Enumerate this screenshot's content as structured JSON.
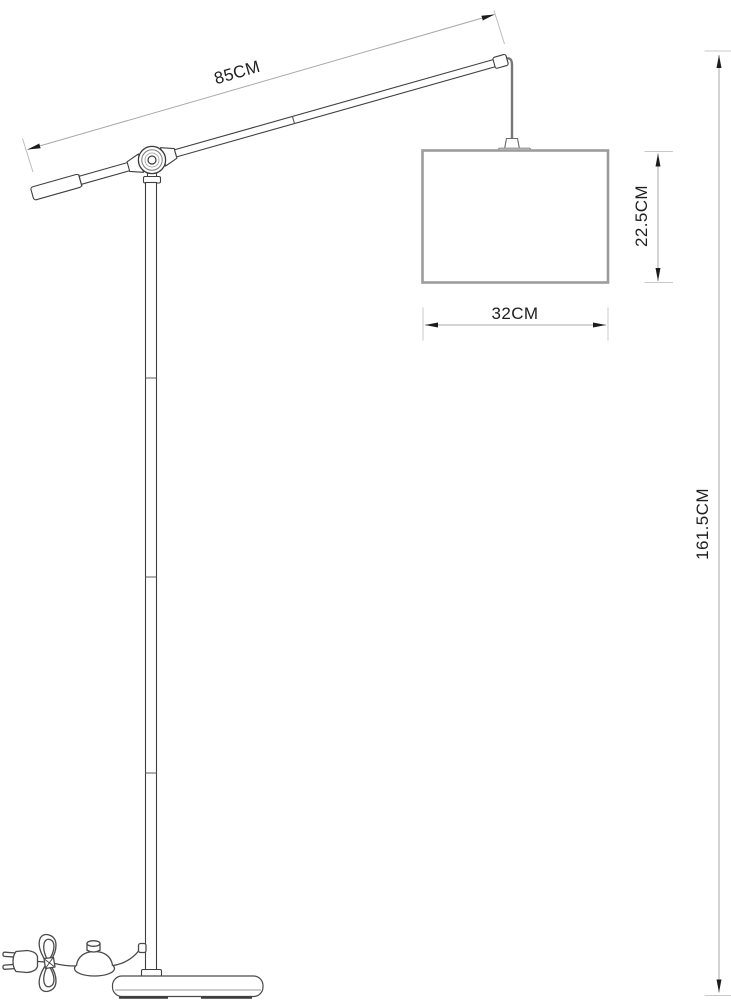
{
  "drawing": {
    "kind": "technical-dimension-drawing",
    "subject": "floor-lamp",
    "background_color": "#ffffff",
    "outline_color": "#3f3f3f",
    "shade_line_color": "#9c9c9c",
    "dimension_line_color": "#a8a8a8",
    "extension_line_color": "#c9c9c9",
    "arrow_color": "#1c1c1c",
    "text_color": "#1f1f1f",
    "dimensions": {
      "arm_length": {
        "label": "85CM",
        "value_cm": 85
      },
      "shade_height": {
        "label": "22.5CM",
        "value_cm": 22.5
      },
      "shade_width": {
        "label": "32CM",
        "value_cm": 32
      },
      "total_height": {
        "label": "161.5CM",
        "value_cm": 161.5
      }
    }
  }
}
